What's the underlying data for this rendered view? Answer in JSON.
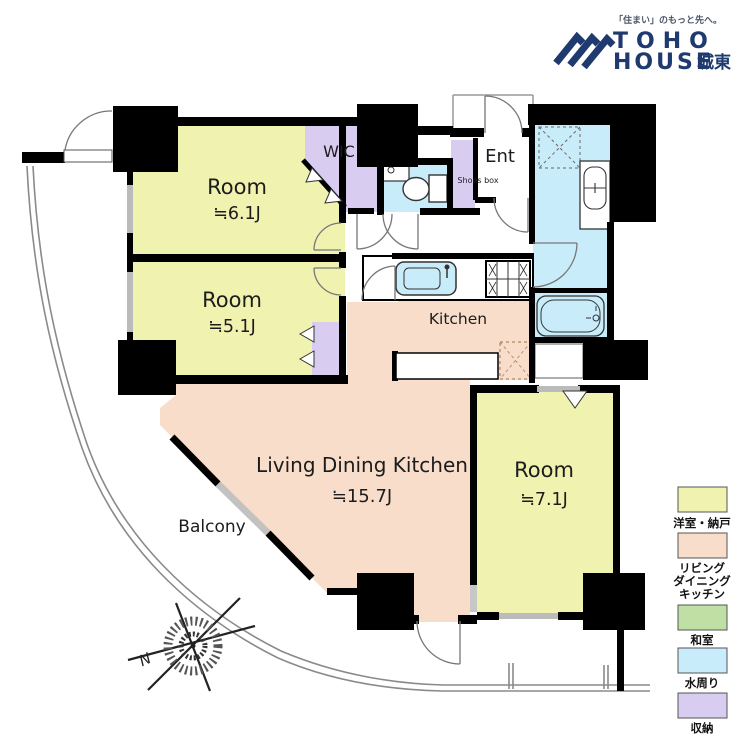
{
  "logo": {
    "tagline": "「住まい」のもっと先へ。",
    "brand_top": "TOHO",
    "brand_bottom": "HOUSE",
    "brand_area": "城東"
  },
  "colors": {
    "room": "#f0f2b0",
    "ldk": "#f7ddca",
    "tatami": "#bfdfa5",
    "water": "#c9ecfa",
    "storage": "#d8cdf0",
    "navy": "#1e3a6e",
    "wall": "#000000"
  },
  "floorplan": {
    "room_6_1": {
      "name": "Room",
      "size": "≒6.1J"
    },
    "room_5_1": {
      "name": "Room",
      "size": "≒5.1J"
    },
    "room_7_1": {
      "name": "Room",
      "size": "≒7.1J"
    },
    "ldk": {
      "name": "Living Dining Kitchen",
      "size": "≒15.7J"
    },
    "kitchen": {
      "name": "Kitchen"
    },
    "wic": {
      "name": "WIC"
    },
    "ent": {
      "name": "Ent"
    },
    "shoes_box": {
      "name": "Shoes box"
    },
    "balcony": {
      "name": "Balcony"
    },
    "compass_north": "N"
  },
  "legend": {
    "items": [
      {
        "label_lines": [
          "洋室・納戸"
        ],
        "color": "#f0f2b0"
      },
      {
        "label_lines": [
          "リビング",
          "ダイニング",
          "キッチン"
        ],
        "color": "#f7ddca"
      },
      {
        "label_lines": [
          "和室"
        ],
        "color": "#bfdfa5"
      },
      {
        "label_lines": [
          "水周り"
        ],
        "color": "#c9ecfa"
      },
      {
        "label_lines": [
          "収納"
        ],
        "color": "#d8cdf0"
      }
    ]
  }
}
